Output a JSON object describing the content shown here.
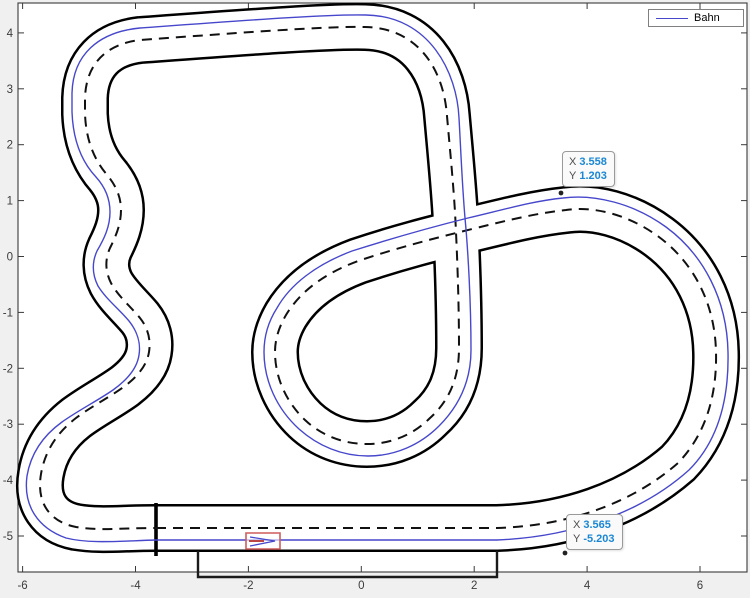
{
  "figure": {
    "background": "#f0f0f0",
    "plot_background": "#ffffff",
    "axis_color": "#3a3a3a",
    "tick_label_color": "#3c3c3c"
  },
  "colors": {
    "track_edge": "#000000",
    "centerline_dash": "#111111",
    "line_blue": "#4747cc",
    "datatip_value_blue": "#1b87d4",
    "car_red": "#cf5b5b"
  },
  "legend": {
    "label": "Bahn",
    "line_color": "#4747cc"
  },
  "axes": {
    "x_ticks": [
      -6,
      -4,
      -2,
      0,
      2,
      4,
      6
    ],
    "y_ticks": [
      4,
      3,
      2,
      1,
      0,
      -1,
      -2,
      -3,
      -4,
      -5
    ],
    "mapping": {
      "x0": 361.3,
      "xs": 56.45,
      "y0": 256.5,
      "ys": 55.9
    },
    "plot_box_px": {
      "left": 18,
      "top": 3,
      "right": 747,
      "bottom": 572
    }
  },
  "datatips": [
    {
      "x_label": "X",
      "x_value": "3.558",
      "y_label": "Y",
      "y_value": "1.203",
      "marker": {
        "x": 561,
        "y": 193
      }
    },
    {
      "x_label": "X",
      "x_value": "3.565",
      "y_label": "Y",
      "y_value": "-5.203",
      "marker": {
        "x": 565,
        "y": 553
      }
    }
  ],
  "track": {
    "center_path": "M 156,528 L 497,528 C 565,526 630,505 678,463 C 707,433 717,393 716,352 C 715,304 694,263 659,237 C 628,214 593,206 566,210 C 538,213 513,219 472,229 C 432,239 400,247 358,261 C 323,274 300,292 286,315 C 279,327 275,339 275,352 C 275,377 286,402 305,420 C 322,436 344,444 367,444 C 391,444 413,435 430,418 C 450,400 459,377 459,348 C 459,300 457,250 455,212 C 453,180 450,150 447,116 C 444,72 420,28 365,27 C 330,26 250,32 140,40 C 106,44 86,64 85,98 L 85,114 C 86,140 94,160 108,176 C 116,186 121,197 121,210 C 121,224 116,236 110,248 C 105,259 105,271 111,283 C 118,296 130,306 140,318 C 148,328 151,340 149,352 C 147,365 138,376 125,386 C 110,397 92,406 76,418 C 58,432 45,450 41,474 C 36,503 50,522 76,527 C 100,531 120,528 156,528 Z",
    "blue_path": "M 156,540 L 497,540 C 570,537 640,514 689,470 C 719,440 729,398 728,352 C 727,300 704,255 666,227 C 633,203 594,194 563,198 C 534,201 510,208 468,218 C 428,228 396,237 352,251 C 315,265 290,285 277,308 C 268,322 264,337 264,352 C 264,381 277,409 299,429 C 318,446 342,456 368,456 C 395,456 420,445 439,426 C 460,405 471,380 471,350 C 471,302 468,250 465,218 C 462,183 461,153 459,118 C 457,73 430,16 366,15 C 330,14 250,20 140,28 C 98,32 73,55 72,93 L 72,112 C 73,140 81,161 96,177 C 105,187 110,199 110,212 C 110,227 104,239 97,251 C 92,262 92,274 98,286 C 106,299 119,309 129,321 C 137,331 141,343 139,355 C 137,369 127,380 113,390 C 97,401 79,410 62,422 C 44,435 31,452 27,476 C 23,506 38,528 66,538 C 90,544 120,541 156,540 Z",
    "start_line": "M 156,503 L 156,556",
    "pit_path": "M 198,551 L 198,577 L 497,577 L 497,551",
    "car_outline": "M 246,533 h 34 v 16 h -34 Z",
    "car_chevron": "M 250,537 L 275,541 L 250,546",
    "car_stripe": "M 249,541 L 264,541"
  },
  "chart_data": {
    "type": "line",
    "title": "",
    "xlabel": "",
    "ylabel": "",
    "xlim": [
      -6.1,
      6.85
    ],
    "ylim": [
      -5.65,
      4.55
    ],
    "grid": false,
    "legend_position": "top-right",
    "series": [
      {
        "name": "Bahn",
        "description": "Closed slot-car race track layout (figure-eight circuit) drawn with black outer edges, dashed black centerline and a blue driving line offset toward the outside of the lane.",
        "track_width_units": 0.85,
        "centerline_waypoints": [
          [
            -3.64,
            -4.86
          ],
          [
            2.4,
            -4.86
          ],
          [
            5.61,
            -3.69
          ],
          [
            6.28,
            -1.71
          ],
          [
            5.27,
            0.35
          ],
          [
            3.63,
            0.83
          ],
          [
            1.96,
            0.49
          ],
          [
            -0.06,
            -0.08
          ],
          [
            -1.53,
            -1.71
          ],
          [
            0.1,
            -3.35
          ],
          [
            1.73,
            -1.67
          ],
          [
            1.66,
            -0.21
          ],
          [
            1.52,
            2.51
          ],
          [
            0.07,
            4.11
          ],
          [
            -3.92,
            3.87
          ],
          [
            -4.89,
            2.84
          ],
          [
            -4.89,
            2.55
          ],
          [
            -4.49,
            1.44
          ],
          [
            -4.26,
            0.83
          ],
          [
            -4.45,
            0.15
          ],
          [
            -4.43,
            -0.47
          ],
          [
            -3.92,
            -1.1
          ],
          [
            -3.76,
            -1.71
          ],
          [
            -4.19,
            -2.32
          ],
          [
            -5.05,
            -2.89
          ],
          [
            -5.67,
            -3.89
          ],
          [
            -5.05,
            -4.84
          ],
          [
            -3.64,
            -4.86
          ]
        ],
        "crossing_point": [
          1.9,
          0.5
        ],
        "start_finish_line_x": -3.64,
        "pit_box_extent": {
          "x": [
            -2.89,
            2.4
          ],
          "y": [
            -5.73,
            -5.27
          ]
        }
      }
    ],
    "annotated_points": [
      {
        "x": 3.558,
        "y": 1.203
      },
      {
        "x": 3.565,
        "y": -5.203
      }
    ]
  }
}
